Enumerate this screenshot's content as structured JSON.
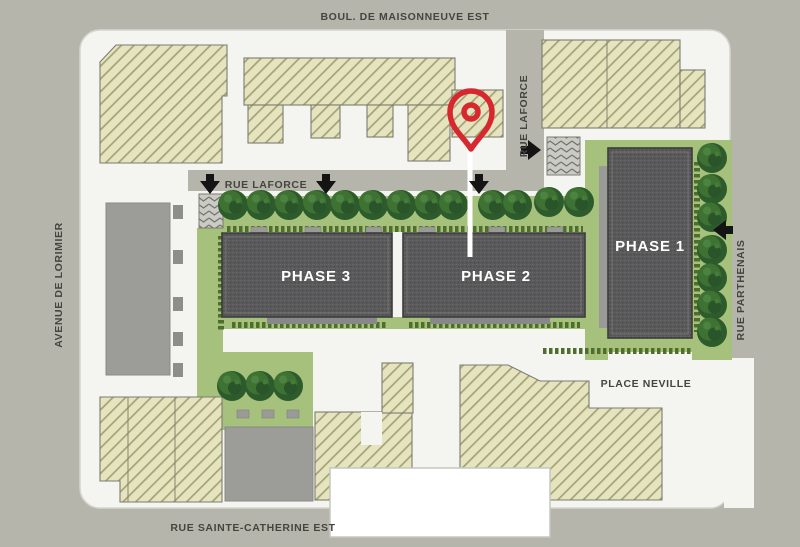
{
  "map": {
    "title": "Site plan with development phases",
    "streets": {
      "maisonneuve": "BOUL. DE MAISONNEUVE EST",
      "laforce_vertical": "RUE LAFORCE",
      "laforce_horizontal": "RUE LAFORCE",
      "lorimier": "AVENUE DE LORIMIER",
      "parthenais": "RUE PARTHENAIS",
      "place_neville": "PLACE NEVILLE",
      "sainte_catherine": "RUE SAINTE-CATHERINE EST"
    },
    "buildings": {
      "phase1": "PHASE 1",
      "phase2": "PHASE 2",
      "phase3": "PHASE 3"
    },
    "colors": {
      "background": "#b6b5ac",
      "site": "#f4f4f1",
      "hatch_fill": "#e5e4bf",
      "hatch_line": "#a3a375",
      "building_dark": "#59585a",
      "building_gray": "#9c9c98",
      "lawn": "#a5c17b",
      "hedge": "#4f6e2d",
      "tree": "#2d5b2c",
      "street_text": "#45453f",
      "phase_text": "#ffffff",
      "pin_red": "#d7282f",
      "arrow_black": "#141414",
      "white_building": "#ffffff"
    }
  }
}
